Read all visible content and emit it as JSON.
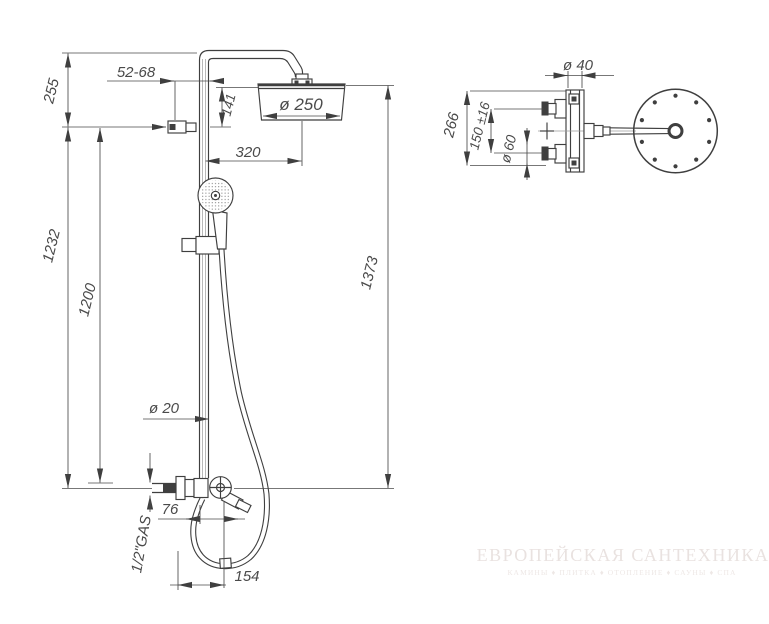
{
  "drawing": {
    "type": "shower column installation dimensions",
    "views": {
      "front": "front view",
      "plan": "top view"
    }
  },
  "dimensions": {
    "front": {
      "wall_offset": "52-68",
      "top_to_bracket": "255",
      "head_drop": "141",
      "head_diameter": "ø 250",
      "arm_reach": "320",
      "bracket_to_inlet": "1232",
      "rail_length": "1200",
      "total_height": "1373",
      "pipe_diameter": "ø 20",
      "outlet_offset": "76",
      "inlet_thread": "1/2\"GAS",
      "hose_extension": "154"
    },
    "plan": {
      "pipe_diameter": "ø 40",
      "body_width": "266",
      "inlet_spacing": "150 ±16",
      "escutcheon_diameter": "ø 60"
    }
  },
  "watermark": {
    "title": "ЕВРОПЕЙСКАЯ САНТЕХНИКА",
    "subtitle": "КАМИНЫ ♦ ПЛИТКА ♦ ОТОПЛЕНИЕ ♦ САУНЫ ♦ СПА"
  },
  "colors": {
    "line": "#3f3f3f",
    "dim": "#4a4a4a",
    "wm": "#e9e2e0",
    "wm2": "#eee8e6",
    "background": "#ffffff"
  }
}
